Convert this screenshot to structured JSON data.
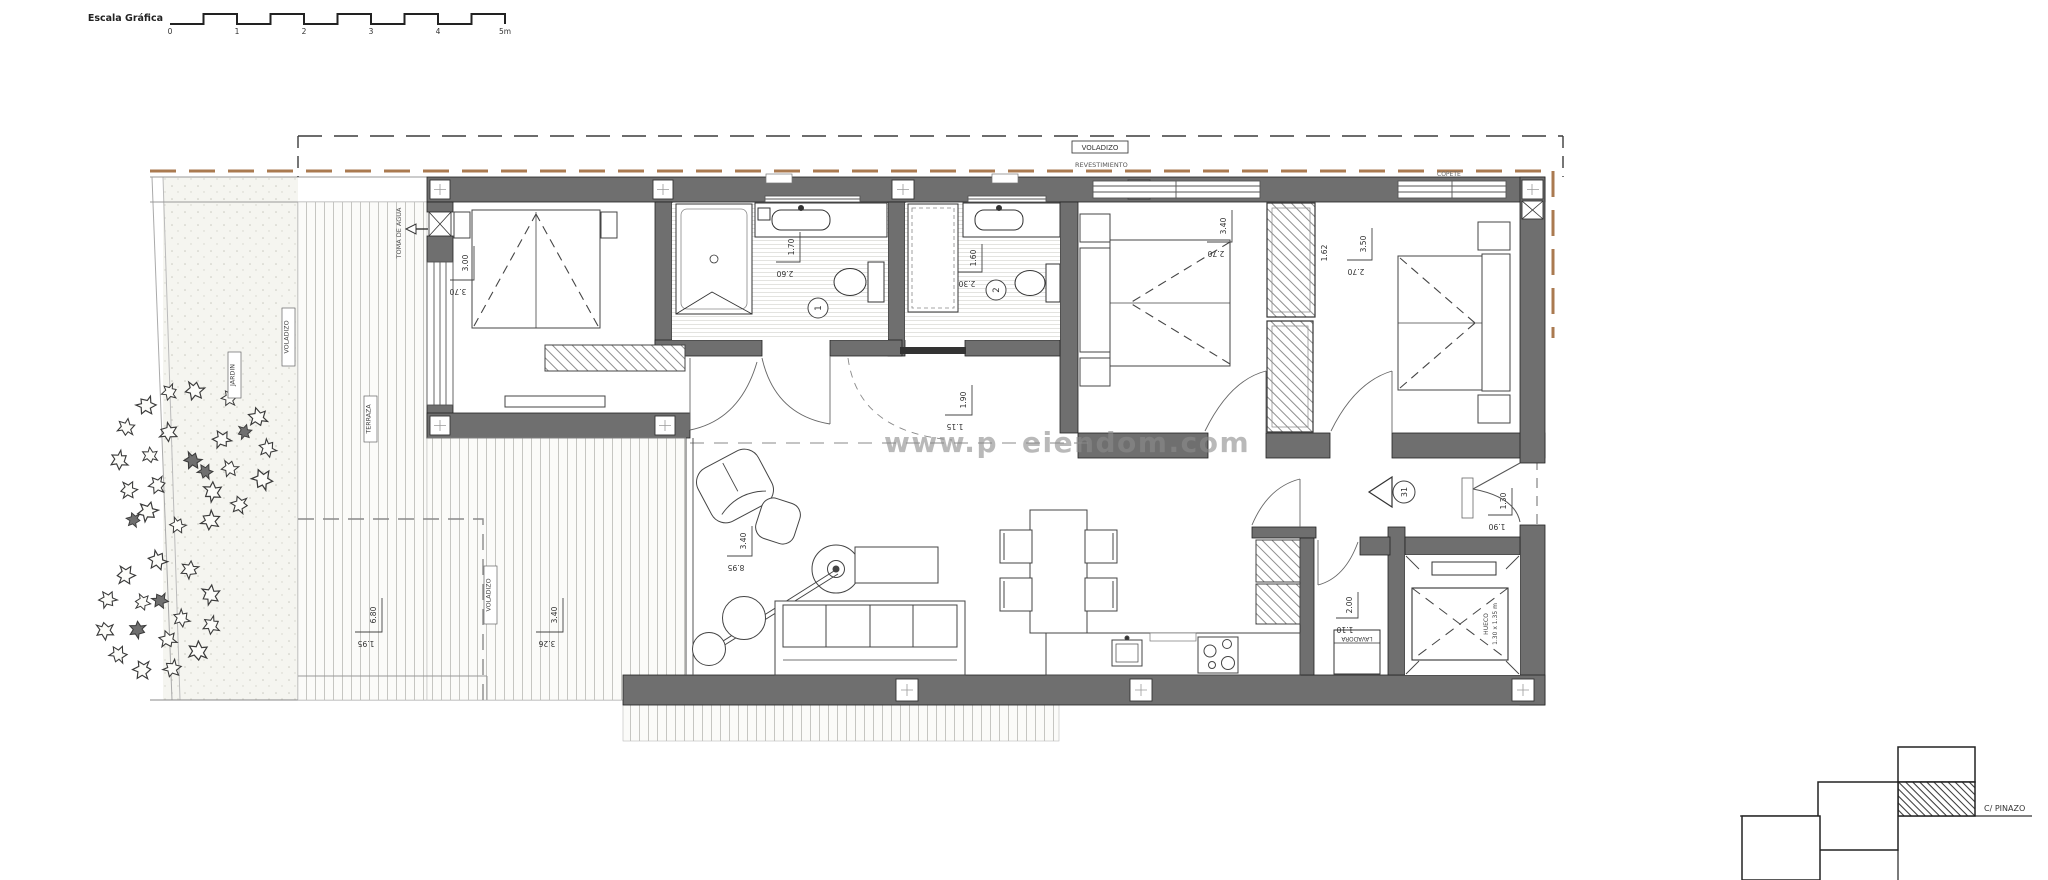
{
  "scale_bar": {
    "label": "Escala Gráfica",
    "ticks": [
      "0",
      "1",
      "2",
      "3",
      "4",
      "5m"
    ]
  },
  "site": {
    "voladizo_top": "VOLADIZO",
    "revestimiento": "REVESTIMIENTO",
    "copete": "COPETE",
    "toma_de_agua": "TOMA DE AGUA",
    "jardin": "JARDIN",
    "terraza": "TERRAZA",
    "voladizo_terrace": "VOLADIZO",
    "street": "C/ PINAZO"
  },
  "watermark": {
    "left": "www.p",
    "right": "eiendom.com"
  },
  "dims": {
    "bedroom1": {
      "v": "3.00",
      "h": "3.70"
    },
    "bath1": {
      "v": "1.70",
      "h": "2.60"
    },
    "bath2": {
      "v": "1.60",
      "h": "2.30"
    },
    "bedroom2": {
      "v": "3.40",
      "h": "2.70"
    },
    "bedroom3": {
      "v": "3.50",
      "h": "2.70",
      "extra": "1.62"
    },
    "living": {
      "v": "3.40",
      "h": "8.95"
    },
    "hall": {
      "v": "1.90",
      "h": "1.15"
    },
    "laundry": {
      "v": "2.00",
      "h": "1.10"
    },
    "entry": {
      "v": "1.30",
      "h": "1.90"
    },
    "terrace_a": {
      "v": "6.80",
      "h": "1.95"
    },
    "terrace_b": {
      "v": "3.40",
      "h": "3.26"
    }
  },
  "tags": {
    "bath1": "1",
    "bath2": "2",
    "entry": "31"
  },
  "labels": {
    "lavadora": "LAVADORA",
    "hueco_line1": "HUECO",
    "hueco_line2": "1.30 x 1.35 m"
  },
  "colors": {
    "wall": "#6f6f6f",
    "boundary_tan": "#aa7a50",
    "line_dark": "#2e2e2e"
  }
}
